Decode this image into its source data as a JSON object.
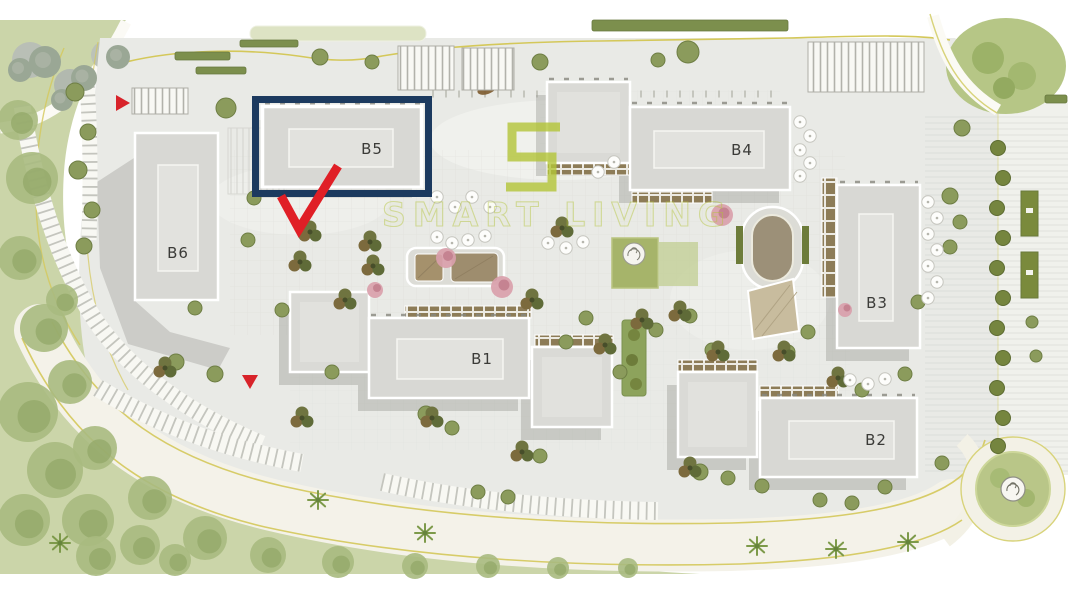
{
  "plan": {
    "buildings": [
      {
        "id": "b5",
        "label": "B5",
        "highlighted": true
      },
      {
        "id": "b6",
        "label": "B6",
        "highlighted": false
      },
      {
        "id": "b4",
        "label": "B4",
        "highlighted": false
      },
      {
        "id": "b3",
        "label": "B3",
        "highlighted": false
      },
      {
        "id": "b1",
        "label": "B1",
        "highlighted": false
      },
      {
        "id": "b2",
        "label": "B2",
        "highlighted": false
      }
    ],
    "unlabeled_buildings": 4,
    "highlight": {
      "target": "B5",
      "frame_color": "#1c3a5f",
      "arrow_color": "#e01f26"
    },
    "markers": {
      "entry_triangle_color": "#d8232a"
    },
    "watermark": {
      "logo_shape": "square-spiral-s",
      "text": "SMART LIVING",
      "color": "#b3c437"
    },
    "colors": {
      "paving": "#e9eae6",
      "building_fill": "#d8d8d4",
      "building_roof": "#e2e2de",
      "landscape": "#cbd5a9",
      "road": "#f4f2e9",
      "road_edge_line": "#d4c85a",
      "shadow": "#9c9c97",
      "balcony": "#8d7c57"
    }
  },
  "features": {
    "soft_trees": [
      [
        18,
        120,
        20
      ],
      [
        32,
        178,
        26
      ],
      [
        20,
        258,
        22
      ],
      [
        44,
        328,
        24
      ],
      [
        62,
        300,
        16
      ],
      [
        28,
        412,
        30
      ],
      [
        70,
        382,
        22
      ],
      [
        55,
        470,
        28
      ],
      [
        24,
        520,
        26
      ],
      [
        95,
        448,
        22
      ],
      [
        88,
        520,
        26
      ],
      [
        150,
        498,
        22
      ],
      [
        140,
        545,
        20
      ],
      [
        205,
        538,
        22
      ],
      [
        268,
        555,
        18
      ],
      [
        338,
        562,
        16
      ],
      [
        415,
        566,
        13
      ],
      [
        488,
        566,
        12
      ],
      [
        558,
        568,
        11
      ],
      [
        628,
        568,
        10
      ],
      [
        96,
        556,
        20
      ],
      [
        175,
        560,
        16
      ]
    ],
    "gray_trees": [
      [
        45,
        62,
        16
      ],
      [
        84,
        78,
        13
      ],
      [
        118,
        57,
        12
      ],
      [
        62,
        100,
        11
      ],
      [
        20,
        70,
        12
      ]
    ],
    "olive_trees": [
      [
        75,
        92,
        9
      ],
      [
        88,
        132,
        8
      ],
      [
        78,
        170,
        9
      ],
      [
        92,
        210,
        8
      ],
      [
        84,
        246,
        8
      ],
      [
        226,
        108,
        10
      ],
      [
        320,
        57,
        8
      ],
      [
        372,
        62,
        7
      ],
      [
        540,
        62,
        8
      ],
      [
        688,
        52,
        11
      ],
      [
        658,
        60,
        7
      ],
      [
        950,
        196,
        8
      ],
      [
        960,
        222,
        7
      ],
      [
        950,
        247,
        7
      ],
      [
        962,
        128,
        8
      ],
      [
        248,
        240,
        7
      ],
      [
        282,
        310,
        7
      ],
      [
        215,
        374,
        8
      ],
      [
        176,
        362,
        8
      ],
      [
        332,
        372,
        7
      ],
      [
        426,
        414,
        8
      ],
      [
        452,
        428,
        7
      ],
      [
        478,
        492,
        7
      ],
      [
        508,
        497,
        7
      ],
      [
        540,
        456,
        7
      ],
      [
        620,
        372,
        7
      ],
      [
        656,
        330,
        7
      ],
      [
        690,
        316,
        7
      ],
      [
        712,
        350,
        7
      ],
      [
        788,
        352,
        7
      ],
      [
        808,
        332,
        7
      ],
      [
        862,
        390,
        7
      ],
      [
        905,
        374,
        7
      ],
      [
        700,
        472,
        8
      ],
      [
        728,
        478,
        7
      ],
      [
        762,
        486,
        7
      ],
      [
        820,
        500,
        7
      ],
      [
        852,
        503,
        7
      ],
      [
        885,
        487,
        7
      ],
      [
        918,
        302,
        7
      ],
      [
        1032,
        322,
        6
      ],
      [
        1036,
        356,
        6
      ],
      [
        942,
        463,
        7
      ],
      [
        195,
        308,
        7
      ],
      [
        254,
        198,
        7
      ],
      [
        586,
        318,
        7
      ],
      [
        566,
        342,
        7
      ]
    ],
    "cluster_trees": [
      [
        310,
        232
      ],
      [
        300,
        262
      ],
      [
        370,
        242
      ],
      [
        373,
        266
      ],
      [
        532,
        300
      ],
      [
        562,
        228
      ],
      [
        642,
        320
      ],
      [
        680,
        312
      ],
      [
        718,
        352
      ],
      [
        784,
        352
      ],
      [
        838,
        378
      ],
      [
        432,
        418
      ],
      [
        522,
        452
      ],
      [
        690,
        468
      ],
      [
        302,
        418
      ],
      [
        165,
        368
      ],
      [
        345,
        300
      ],
      [
        605,
        345
      ]
    ],
    "pink_trees": [
      [
        446,
        258,
        10
      ],
      [
        502,
        287,
        11
      ],
      [
        722,
        215,
        11
      ],
      [
        375,
        290,
        8
      ],
      [
        845,
        310,
        7
      ]
    ],
    "palms": [
      [
        318,
        500
      ],
      [
        425,
        533
      ],
      [
        757,
        546
      ],
      [
        836,
        549
      ],
      [
        908,
        542
      ],
      [
        60,
        543
      ]
    ],
    "umbrellas": [
      [
        437,
        197
      ],
      [
        455,
        207
      ],
      [
        472,
        197
      ],
      [
        490,
        207
      ],
      [
        437,
        237
      ],
      [
        452,
        243
      ],
      [
        468,
        240
      ],
      [
        485,
        236
      ],
      [
        548,
        243
      ],
      [
        566,
        248
      ],
      [
        583,
        242
      ],
      [
        598,
        172
      ],
      [
        614,
        162
      ],
      [
        800,
        122
      ],
      [
        810,
        136
      ],
      [
        800,
        150
      ],
      [
        810,
        163
      ],
      [
        800,
        176
      ],
      [
        928,
        202
      ],
      [
        937,
        218
      ],
      [
        928,
        234
      ],
      [
        937,
        250
      ],
      [
        928,
        266
      ],
      [
        937,
        282
      ],
      [
        928,
        298
      ],
      [
        850,
        380
      ],
      [
        868,
        384
      ],
      [
        885,
        379
      ]
    ],
    "bushes": [
      [
        998,
        148
      ],
      [
        1003,
        178
      ],
      [
        997,
        208
      ],
      [
        1003,
        238
      ],
      [
        997,
        268
      ],
      [
        1003,
        298
      ],
      [
        997,
        328
      ],
      [
        1003,
        358
      ],
      [
        997,
        388
      ],
      [
        1003,
        418
      ],
      [
        998,
        446
      ]
    ],
    "balcony_strips": [
      [
        547,
        163,
        83,
        12
      ],
      [
        632,
        192,
        80,
        11
      ],
      [
        405,
        306,
        126,
        12
      ],
      [
        535,
        335,
        78,
        11
      ],
      [
        678,
        360,
        79,
        11
      ],
      [
        760,
        386,
        78,
        11
      ],
      [
        822,
        178,
        15,
        119
      ]
    ],
    "parking_bands": [
      [
        "M 86,70 C 90,120 91,170 89,240",
        15
      ],
      [
        "M 22,105 C 34,185 58,262 95,320 C 130,372 190,414 262,444",
        17
      ],
      [
        "M 98,388 C 150,420 212,446 302,463",
        18
      ],
      [
        "M 382,482 C 470,502 572,510 658,511",
        18
      ]
    ],
    "stripe_lots": [
      [
        132,
        88,
        56,
        26
      ],
      [
        398,
        46,
        56,
        44
      ],
      [
        462,
        48,
        52,
        42
      ],
      [
        808,
        42,
        116,
        50
      ]
    ],
    "hedges": [
      [
        175,
        52,
        55,
        8
      ],
      [
        196,
        67,
        50,
        7
      ],
      [
        592,
        20,
        196,
        11
      ],
      [
        240,
        40,
        58,
        7
      ],
      [
        1045,
        95,
        22,
        8
      ]
    ]
  }
}
